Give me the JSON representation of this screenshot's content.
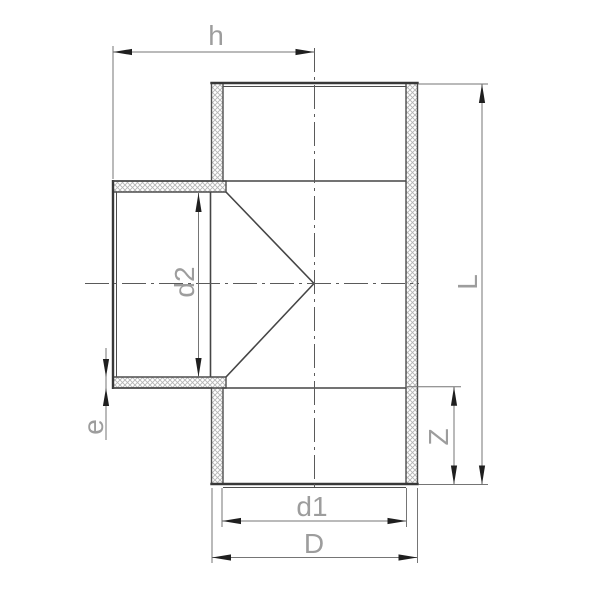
{
  "drawing": {
    "dimensions": {
      "h": {
        "label": "h"
      },
      "d2": {
        "label": "d2"
      },
      "e": {
        "label": "e"
      },
      "d1": {
        "label": "d1"
      },
      "D": {
        "label": "D"
      },
      "Z": {
        "label": "Z"
      },
      "L": {
        "label": "L"
      }
    },
    "colors": {
      "background": "#ffffff",
      "outline": "#383838",
      "interior_line": "#4a4a4a",
      "hatch": "#b5b5b5",
      "dimension_line": "#757575",
      "arrowhead": "#1f1f1f",
      "centerline": "#5a5a5a",
      "label_text": "#9d9d9d"
    }
  }
}
